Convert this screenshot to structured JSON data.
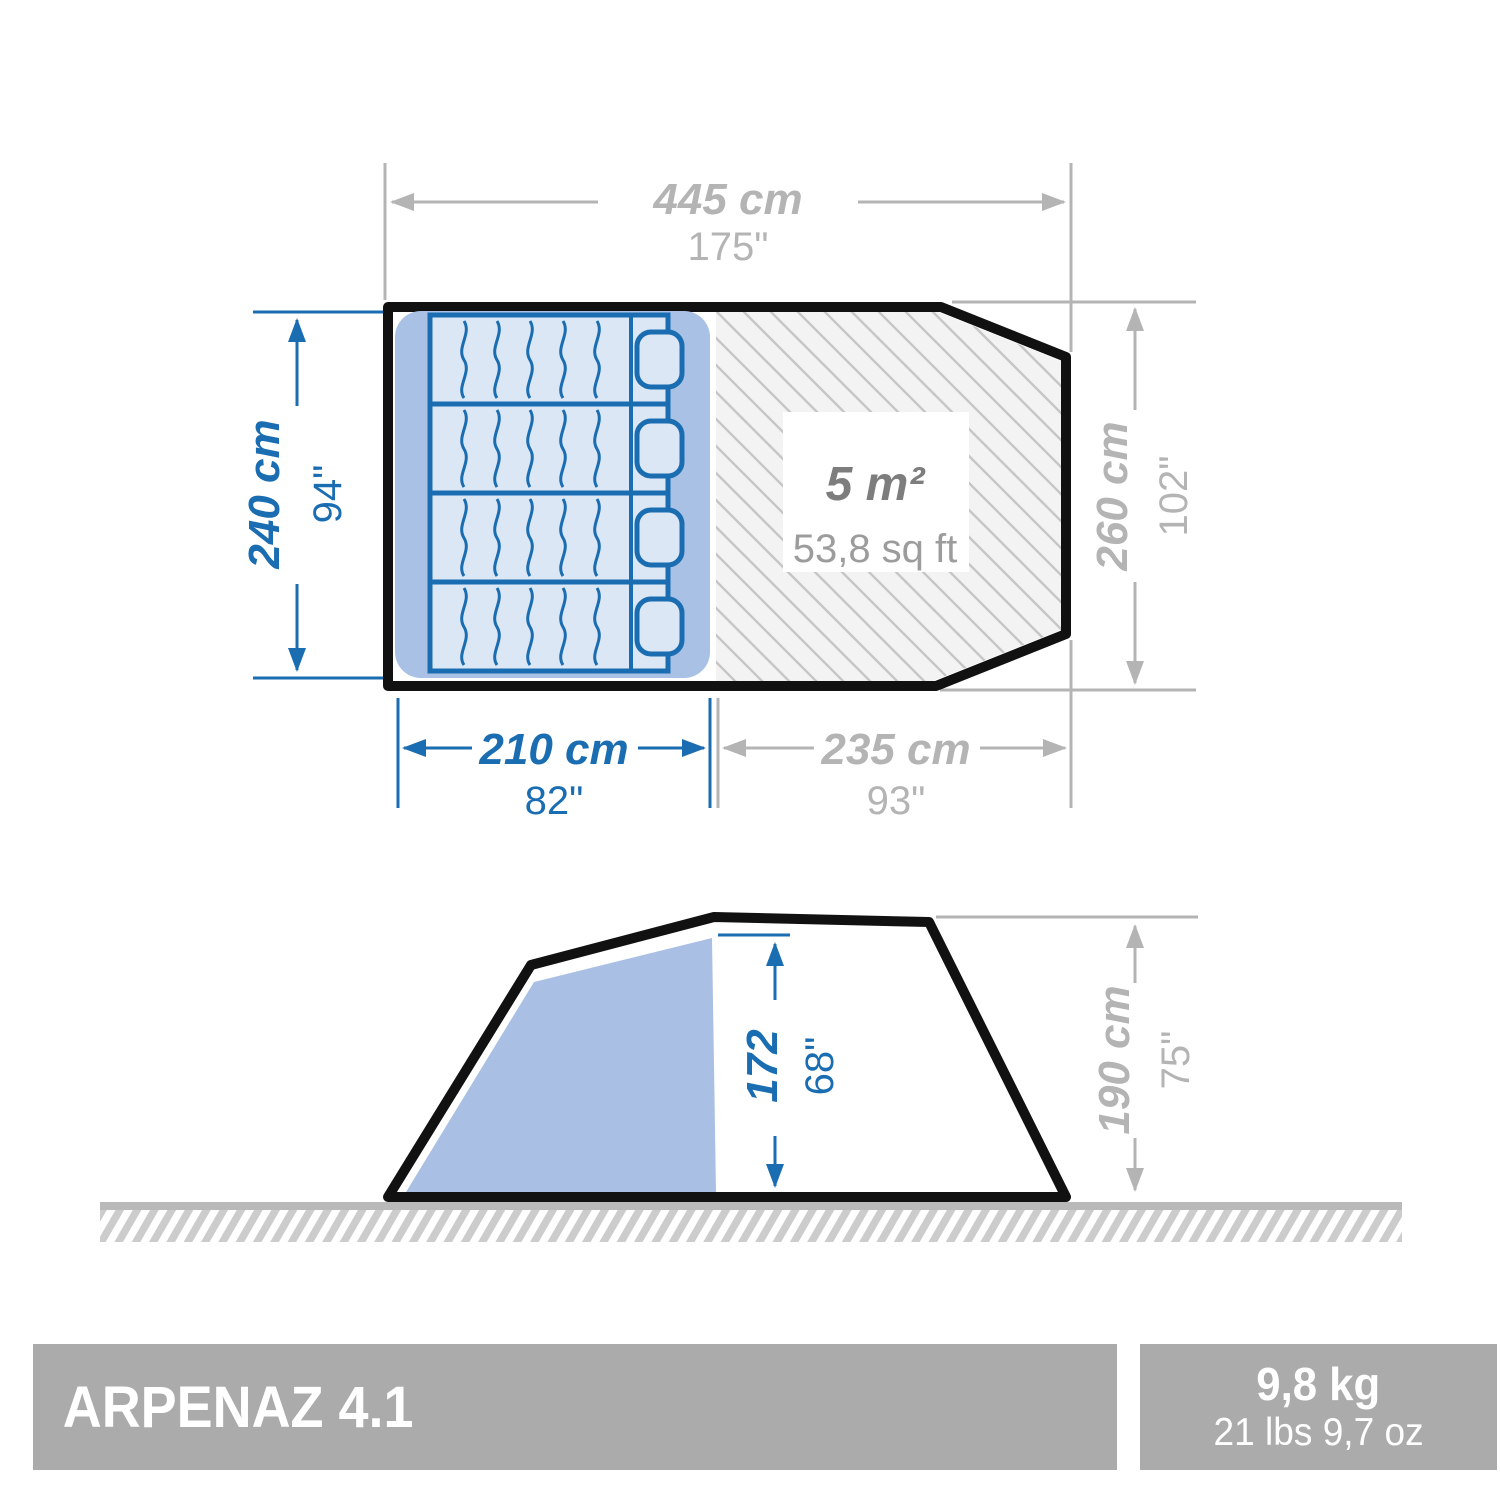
{
  "product": {
    "name": "ARPENAZ 4.1",
    "weight_metric": "9,8 kg",
    "weight_imperial": "21 lbs 9,7 oz"
  },
  "top_view": {
    "total_width_cm": "445 cm",
    "total_width_in": "175\"",
    "bedroom_depth_cm": "240 cm",
    "bedroom_depth_in": "94\"",
    "total_depth_cm": "260 cm",
    "total_depth_in": "102\"",
    "bedroom_width_cm": "210 cm",
    "bedroom_width_in": "82\"",
    "living_width_cm": "235 cm",
    "living_width_in": "93\"",
    "living_area_m2": "5 m²",
    "living_area_sqft": "53,8 sq ft"
  },
  "side_view": {
    "interior_height_cm": "172",
    "interior_height_in": "68\"",
    "total_height_cm": "190 cm",
    "total_height_in": "75\""
  },
  "colors": {
    "dimension_blue": "#1a6db1",
    "dimension_gray": "#b4b4b4",
    "outline_black": "#111111",
    "bedroom_fill": "#a8c1e4",
    "mattress_fill": "#dce7f6",
    "side_tent_fill": "#a9c0e4",
    "living_fill": "#f3f3f3",
    "hatch_line": "#c6c6c6",
    "ground_gray": "#b9b9b9",
    "ground_stripe": "#cccccc",
    "bar_gray": "#ababab",
    "area_text_dark": "#7d7d7d",
    "area_text_light": "#9c9c9c"
  }
}
